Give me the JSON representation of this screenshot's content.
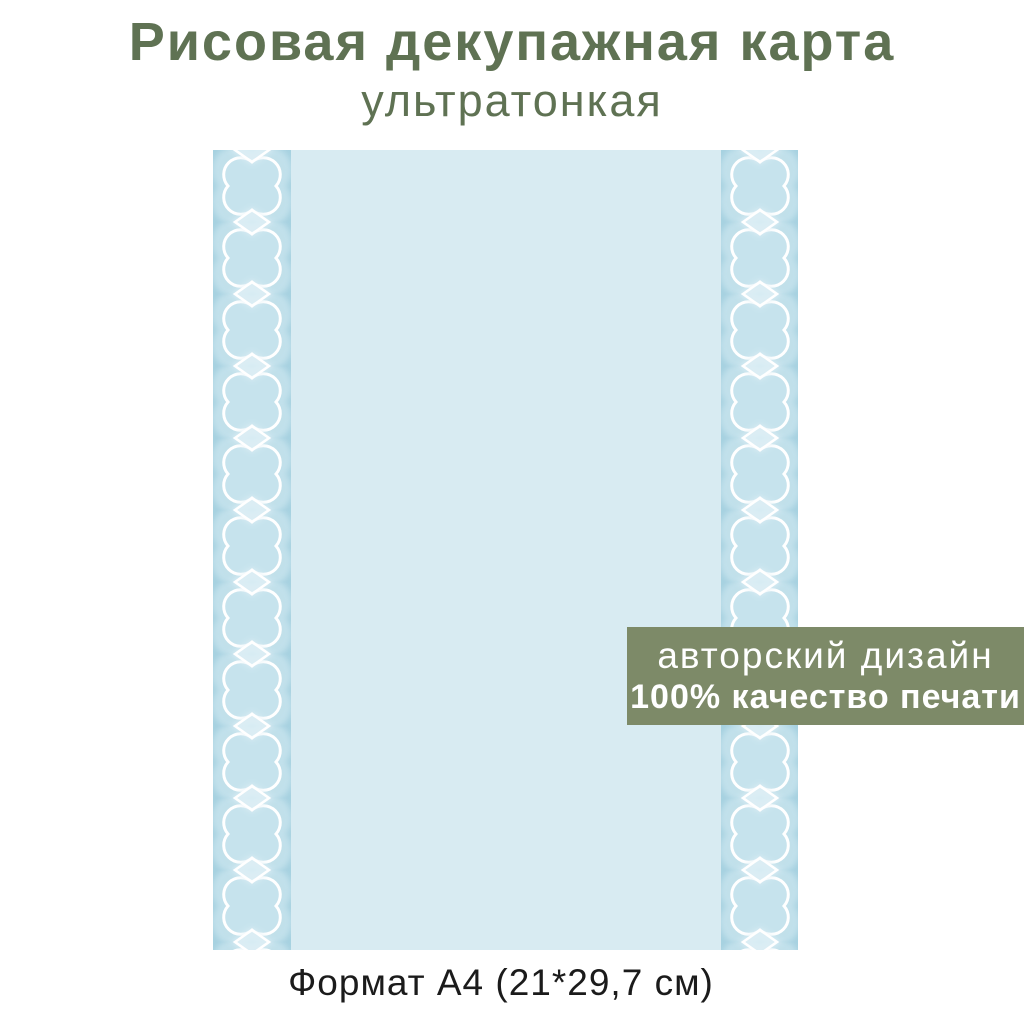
{
  "header": {
    "title": "Рисовая декупажная карта",
    "subtitle": "ультратонкая"
  },
  "paper": {
    "format_label": "Формат А4 (21*29,7 см)",
    "motif": "quatrefoil-and-diamond-border"
  },
  "badge": {
    "line1": "авторский дизайн",
    "line2": "100% качество печати"
  },
  "colors": {
    "title-text": "#5f7253",
    "badge-bg": "#7d8a68",
    "badge-text": "#ffffff",
    "paper-bg": "#d8ebf2",
    "strip-bg": "#a6d1e0",
    "motif-light": "#c6e3ed",
    "motif-outline": "#ffffff",
    "format-text": "#1b1b1b"
  }
}
